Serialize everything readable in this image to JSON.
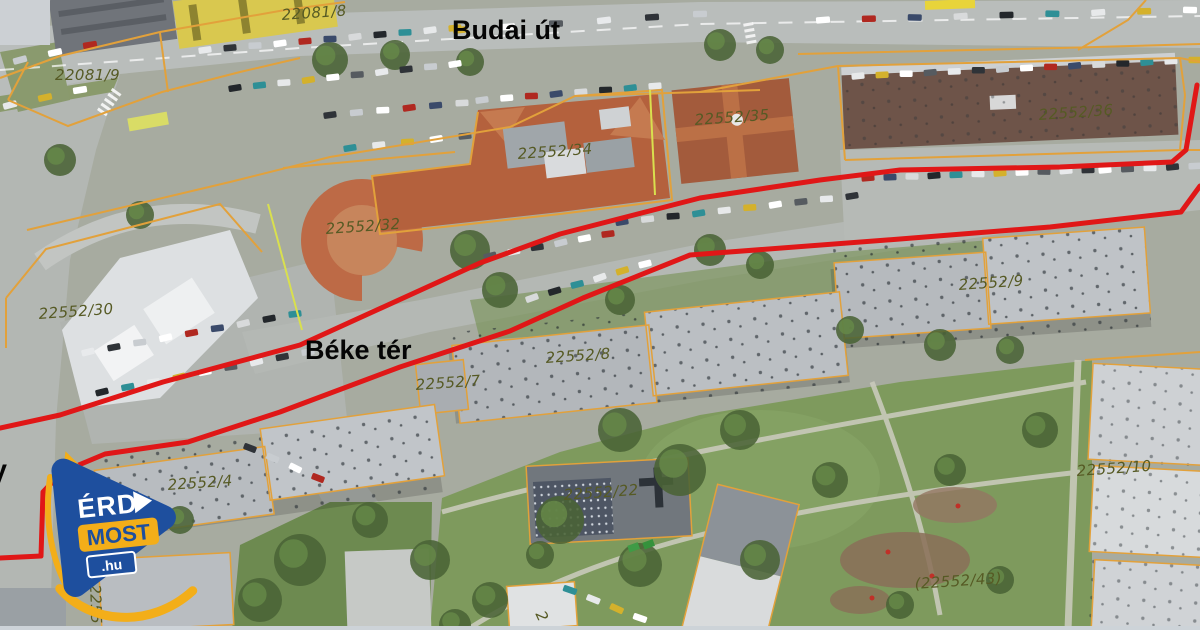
{
  "map": {
    "street_labels": [
      {
        "text": "Budai út",
        "x": 452,
        "y": 15,
        "rot": 0
      },
      {
        "text": "Béke tér",
        "x": 305,
        "y": 335,
        "rot": 0
      },
      {
        "text": "V",
        "x": -11,
        "y": 459,
        "rot": 0
      }
    ],
    "parcel_labels": [
      {
        "text": "22081/8",
        "x": 281,
        "y": 6,
        "rot": -4
      },
      {
        "text": "22081/9",
        "x": 55,
        "y": 66,
        "rot": 0
      },
      {
        "text": "22552/34",
        "x": 517,
        "y": 145,
        "rot": -4
      },
      {
        "text": "22552/35",
        "x": 694,
        "y": 111,
        "rot": -4
      },
      {
        "text": "22552/36",
        "x": 1038,
        "y": 106,
        "rot": -4
      },
      {
        "text": "22552/32",
        "x": 325,
        "y": 220,
        "rot": -4
      },
      {
        "text": "22552/30",
        "x": 38,
        "y": 305,
        "rot": -4
      },
      {
        "text": "22552/8",
        "x": 545,
        "y": 349,
        "rot": -4
      },
      {
        "text": "22552/7",
        "x": 415,
        "y": 376,
        "rot": -4
      },
      {
        "text": "22552/9",
        "x": 958,
        "y": 276,
        "rot": -4
      },
      {
        "text": "22552/4",
        "x": 167,
        "y": 476,
        "rot": -4
      },
      {
        "text": "22552/22",
        "x": 563,
        "y": 486,
        "rot": -4
      },
      {
        "text": "22552/10",
        "x": 1076,
        "y": 462,
        "rot": -4
      },
      {
        "text": "(22552/43)",
        "x": 914,
        "y": 575,
        "rot": -4
      },
      {
        "text": "2255",
        "x": 104,
        "y": 584,
        "rot": 88
      },
      {
        "text": "2",
        "x": 548,
        "y": 608,
        "rot": 65
      }
    ],
    "colors": {
      "route_red": "#e01717",
      "cadastral_orange": "#e2a13b",
      "cadastral_yellow_green": "#d9e04e",
      "parcel_label": "#565a24",
      "street_label": "#050505"
    }
  },
  "logo": {
    "line1": "ÉRD",
    "line2": "MOST",
    "line3": ".hu",
    "blue": "#1e4f9e",
    "yellow": "#f3ae19"
  }
}
